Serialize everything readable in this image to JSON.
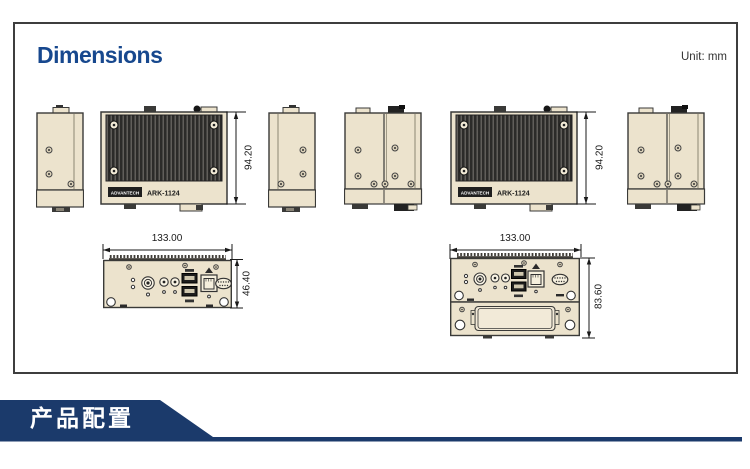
{
  "page": {
    "title": "Dimensions",
    "unit_label": "Unit: mm"
  },
  "footer": {
    "banner_label": "产品配置"
  },
  "product": {
    "brand": "ADVANTECH",
    "model": "ARK-1124"
  },
  "dims": {
    "front_height_left": "94.20",
    "front_height_right": "94.20",
    "bottom_width_left": "133.00",
    "bottom_width_right": "133.00",
    "io_panel_height": "46.40",
    "expansion_panel_height": "83.60"
  },
  "colors": {
    "accent_navy": "#1b3a6b",
    "title_blue": "#17488e",
    "chassis_beige": "#ece3cd",
    "heatsink_dark": "#2c2b29"
  }
}
